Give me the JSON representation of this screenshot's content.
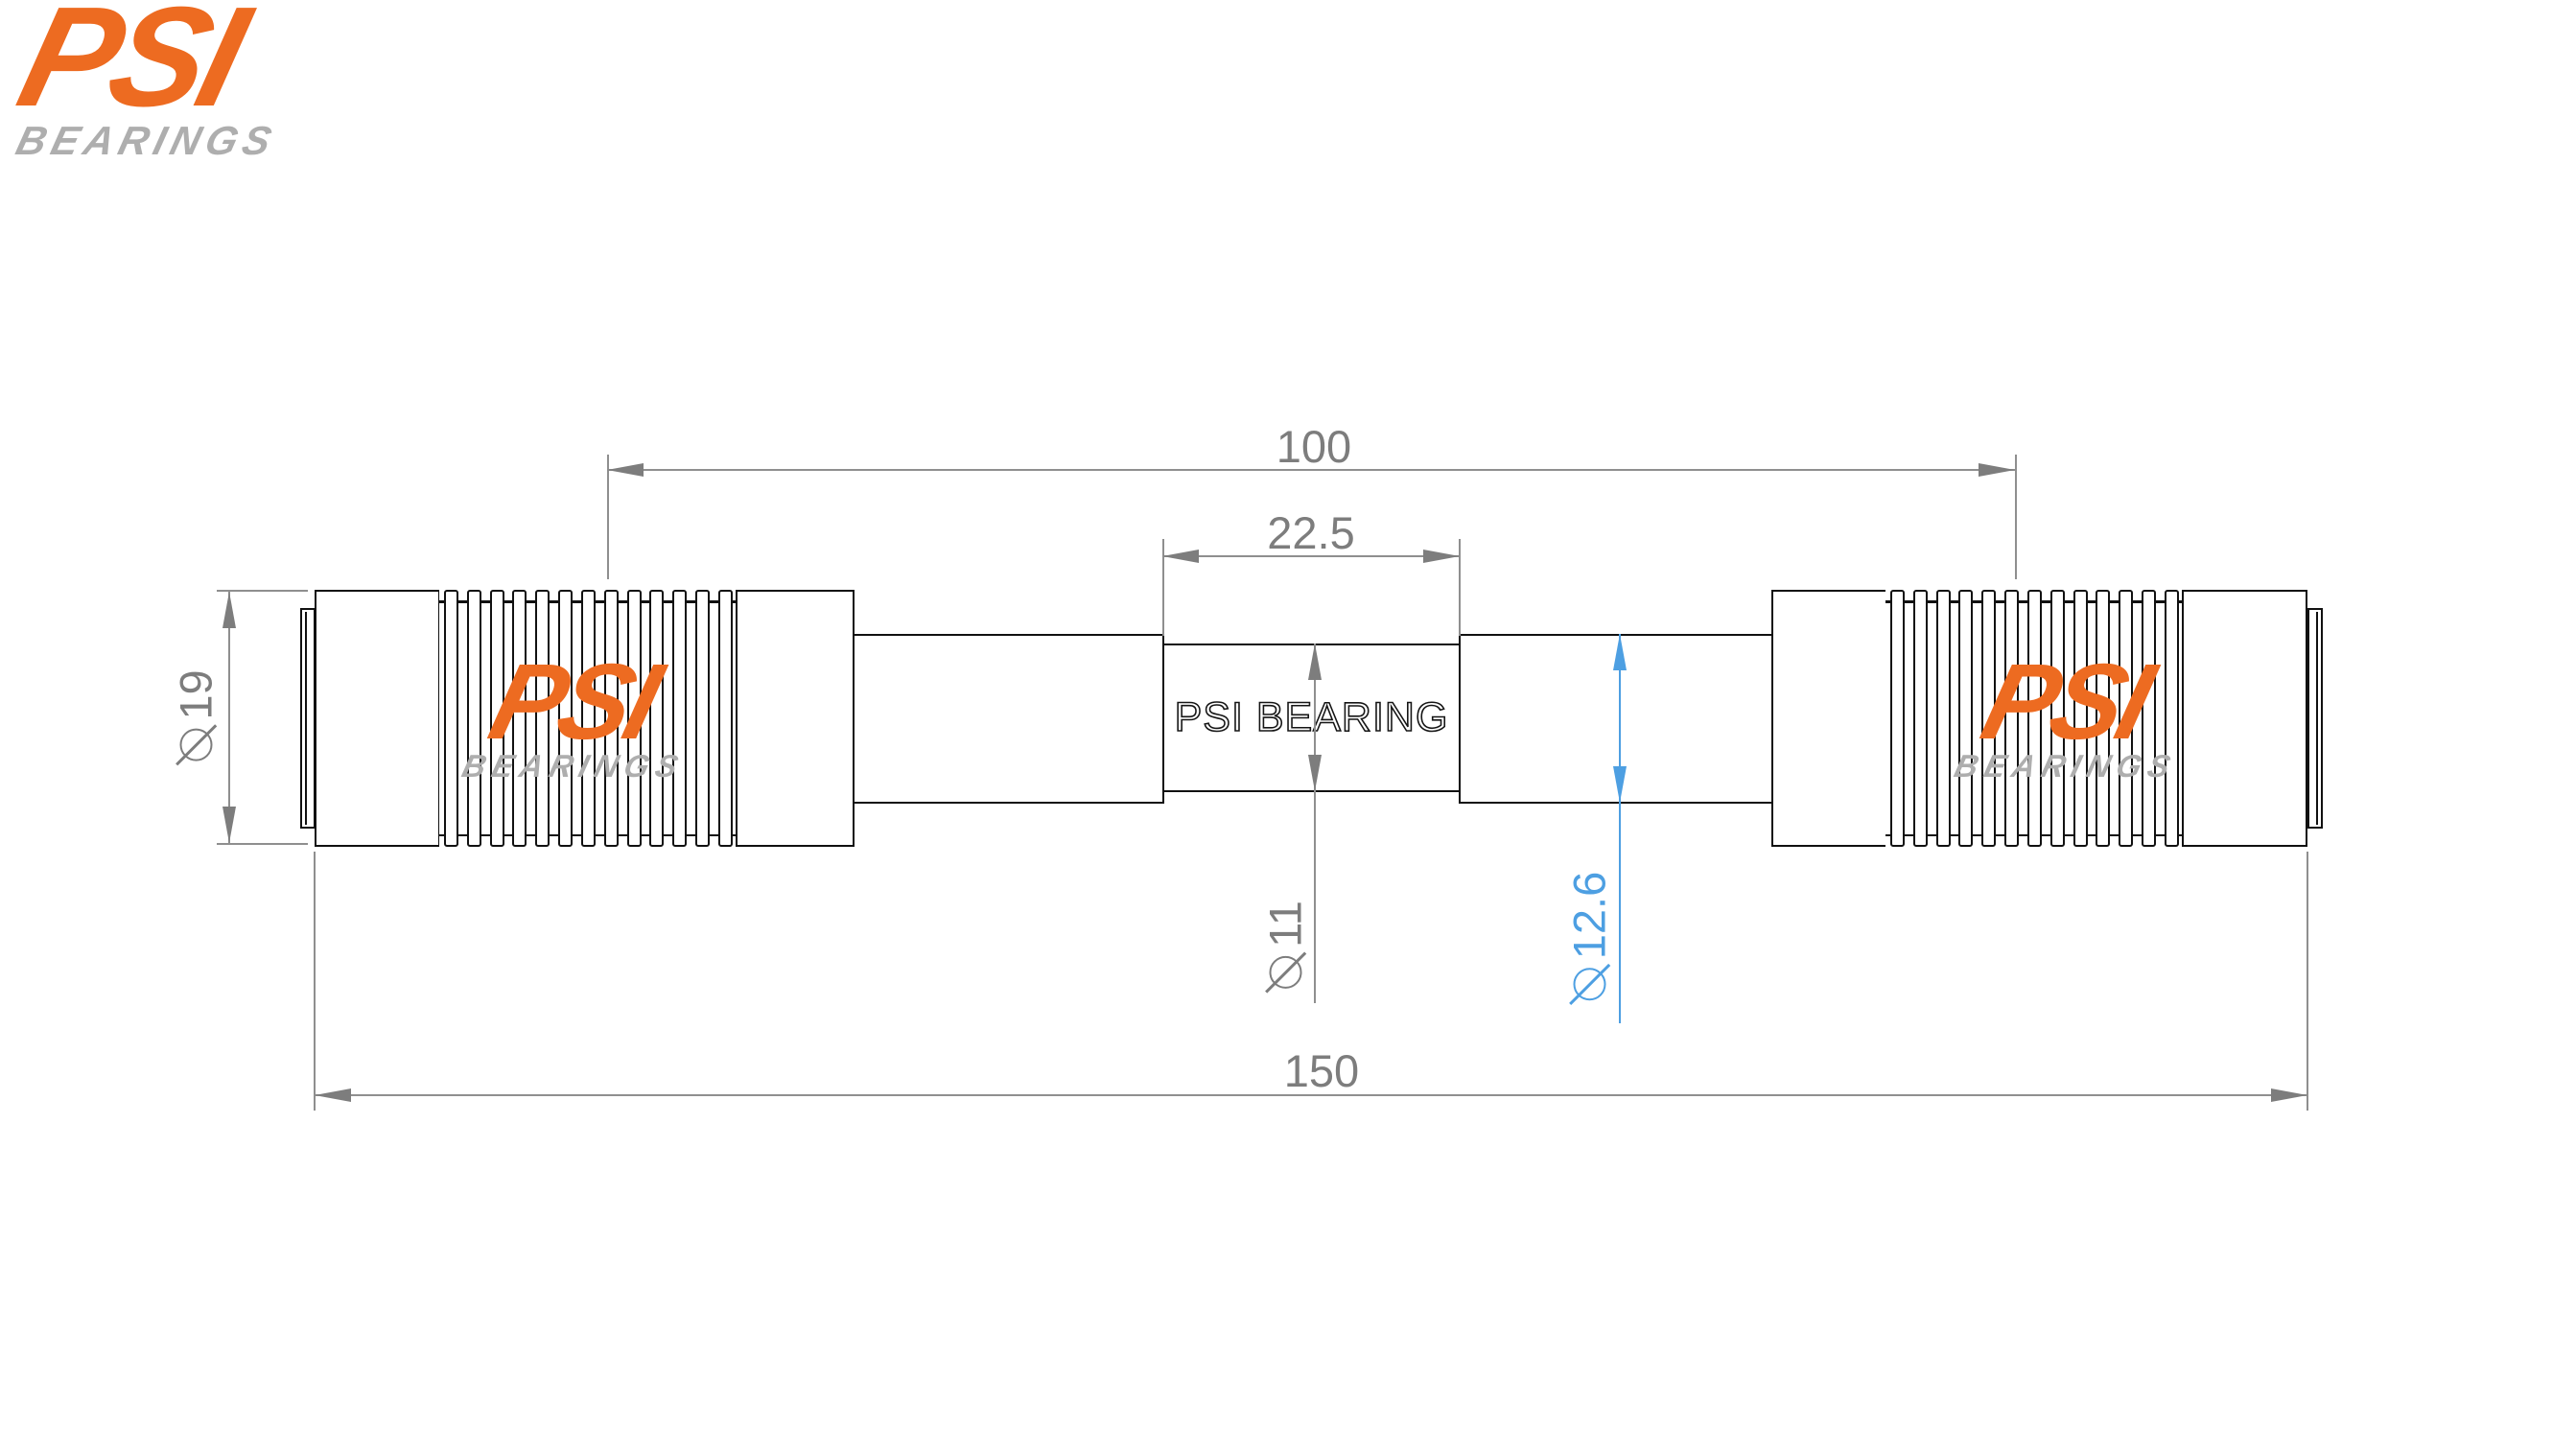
{
  "colors": {
    "accent_orange": "#ED6B21",
    "logo_gray": "#AEAEAE",
    "line_black": "#111111",
    "dim_gray_text": "#7D7D7D",
    "dim_gray_line": "#8F8F8F",
    "highlight_blue": "#4D9FE2",
    "paper": "#FFFFFF"
  },
  "logo": {
    "name": "PSI",
    "tagline": "BEARINGS"
  },
  "watermark": {
    "name": "PSI",
    "tagline": "BEARINGS"
  },
  "part": {
    "center_label": "PSI BEARING"
  },
  "dimensions": {
    "span": {
      "value": "100"
    },
    "center_section": {
      "value": "22.5"
    },
    "overall_length": {
      "value": "150"
    },
    "end_diameter": {
      "symbol": "⌀",
      "value": "19"
    },
    "center_diameter": {
      "symbol": "⌀",
      "value": "11"
    },
    "seat_diameter": {
      "symbol": "⌀",
      "value": "12.6",
      "color": "#4D9FE2"
    }
  }
}
